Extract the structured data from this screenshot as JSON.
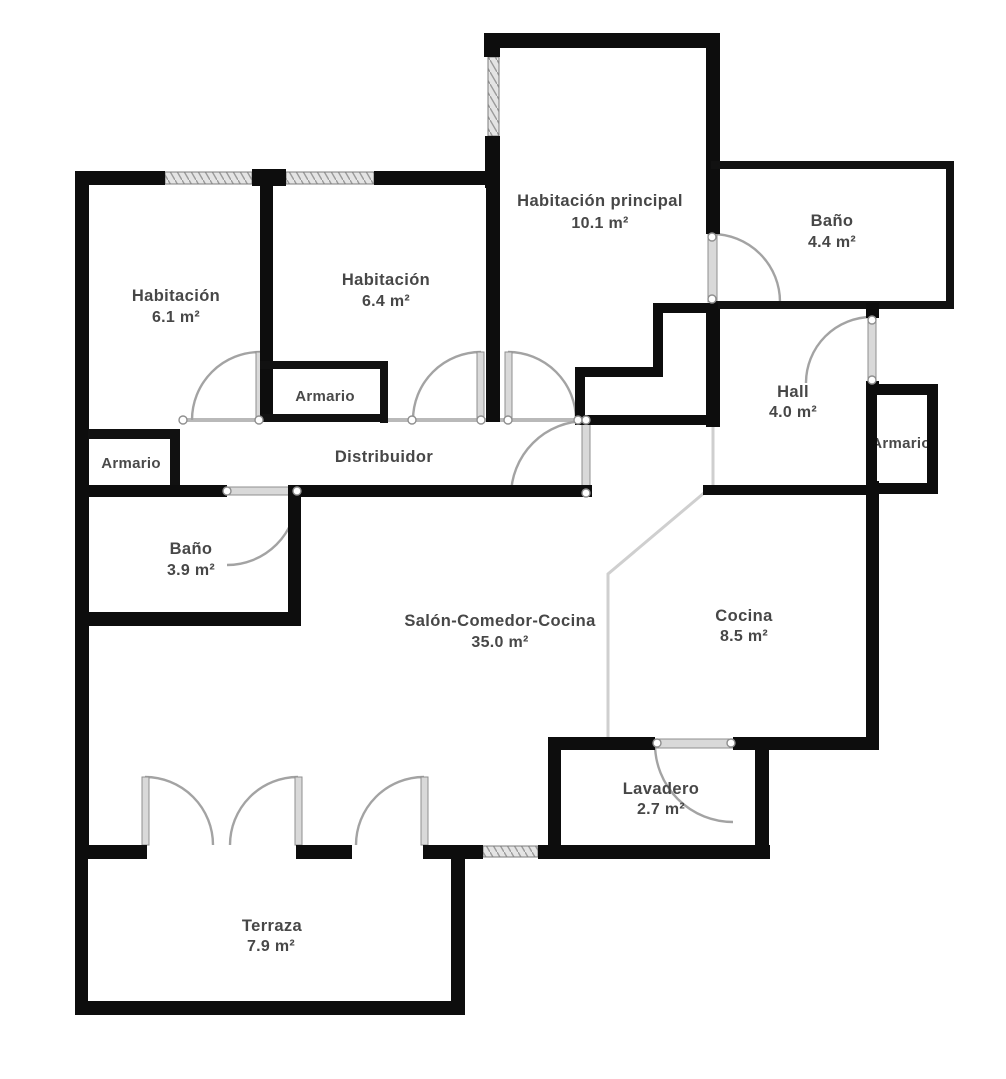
{
  "plan": {
    "type": "apartment-floor-plan",
    "rooms": [
      {
        "name": "Habitación principal",
        "area": "10.1 m²"
      },
      {
        "name": "Baño",
        "area": "4.4 m²"
      },
      {
        "name": "Habitación",
        "area": "6.1 m²"
      },
      {
        "name": "Habitación",
        "area": "6.4 m²"
      },
      {
        "name": "Armario",
        "area": ""
      },
      {
        "name": "Armario",
        "area": ""
      },
      {
        "name": "Distribuidor",
        "area": ""
      },
      {
        "name": "Hall",
        "area": "4.0 m²"
      },
      {
        "name": "Armario",
        "area": ""
      },
      {
        "name": "Baño",
        "area": "3.9 m²"
      },
      {
        "name": "Salón-Comedor-Cocina",
        "area": "35.0 m²"
      },
      {
        "name": "Cocina",
        "area": "8.5 m²"
      },
      {
        "name": "Lavadero",
        "area": "2.7 m²"
      },
      {
        "name": "Terraza",
        "area": "7.9 m²"
      }
    ],
    "colors": {
      "wall": "#0d0d0d",
      "label_text": "#474747",
      "door_arc": "#a3a3a3",
      "window_fill": "#e4e4e4",
      "background": "#ffffff"
    }
  }
}
